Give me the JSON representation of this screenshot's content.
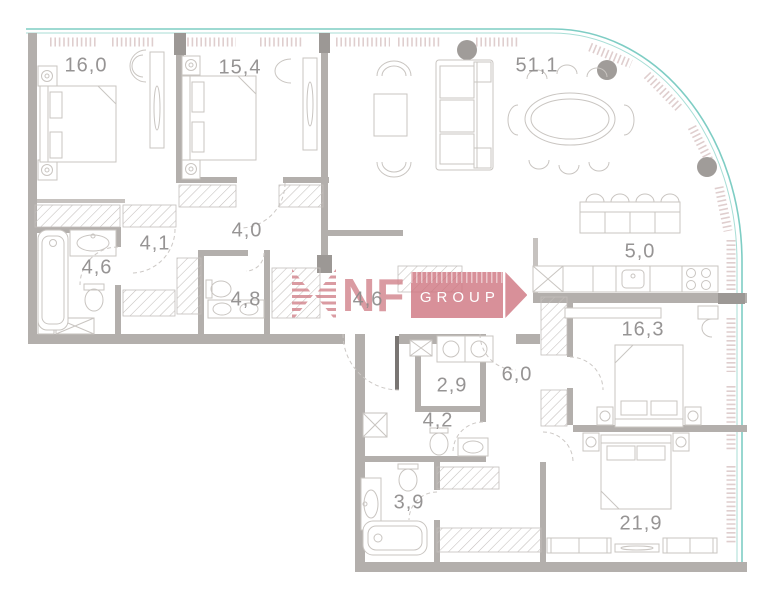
{
  "brand": {
    "k": "K",
    "nf": "NF",
    "group": "GROUP"
  },
  "rooms": [
    {
      "name": "bedroom-1",
      "area": "16,0"
    },
    {
      "name": "bedroom-2",
      "area": "15,4"
    },
    {
      "name": "living-dining",
      "area": "51,1"
    },
    {
      "name": "bathroom-1",
      "area": "4,6"
    },
    {
      "name": "hall-1",
      "area": "4,1"
    },
    {
      "name": "hall-2",
      "area": "4,0"
    },
    {
      "name": "bathroom-2",
      "area": "4,8"
    },
    {
      "name": "corridor",
      "area": "4,6"
    },
    {
      "name": "kitchen",
      "area": "5,0"
    },
    {
      "name": "bedroom-3",
      "area": "16,3"
    },
    {
      "name": "hall-3",
      "area": "6,0"
    },
    {
      "name": "laundry",
      "area": "2,9"
    },
    {
      "name": "bathroom-3",
      "area": "4,2"
    },
    {
      "name": "bathroom-4",
      "area": "3,9"
    },
    {
      "name": "bedroom-4",
      "area": "21,9"
    }
  ],
  "colors": {
    "glass_teal": "#7ecdc4",
    "wall_gray": "#b3afac",
    "logo_pink": "#d2838b",
    "label_gray": "#8e8b8b",
    "convector_pink": "#d9c6c5"
  }
}
